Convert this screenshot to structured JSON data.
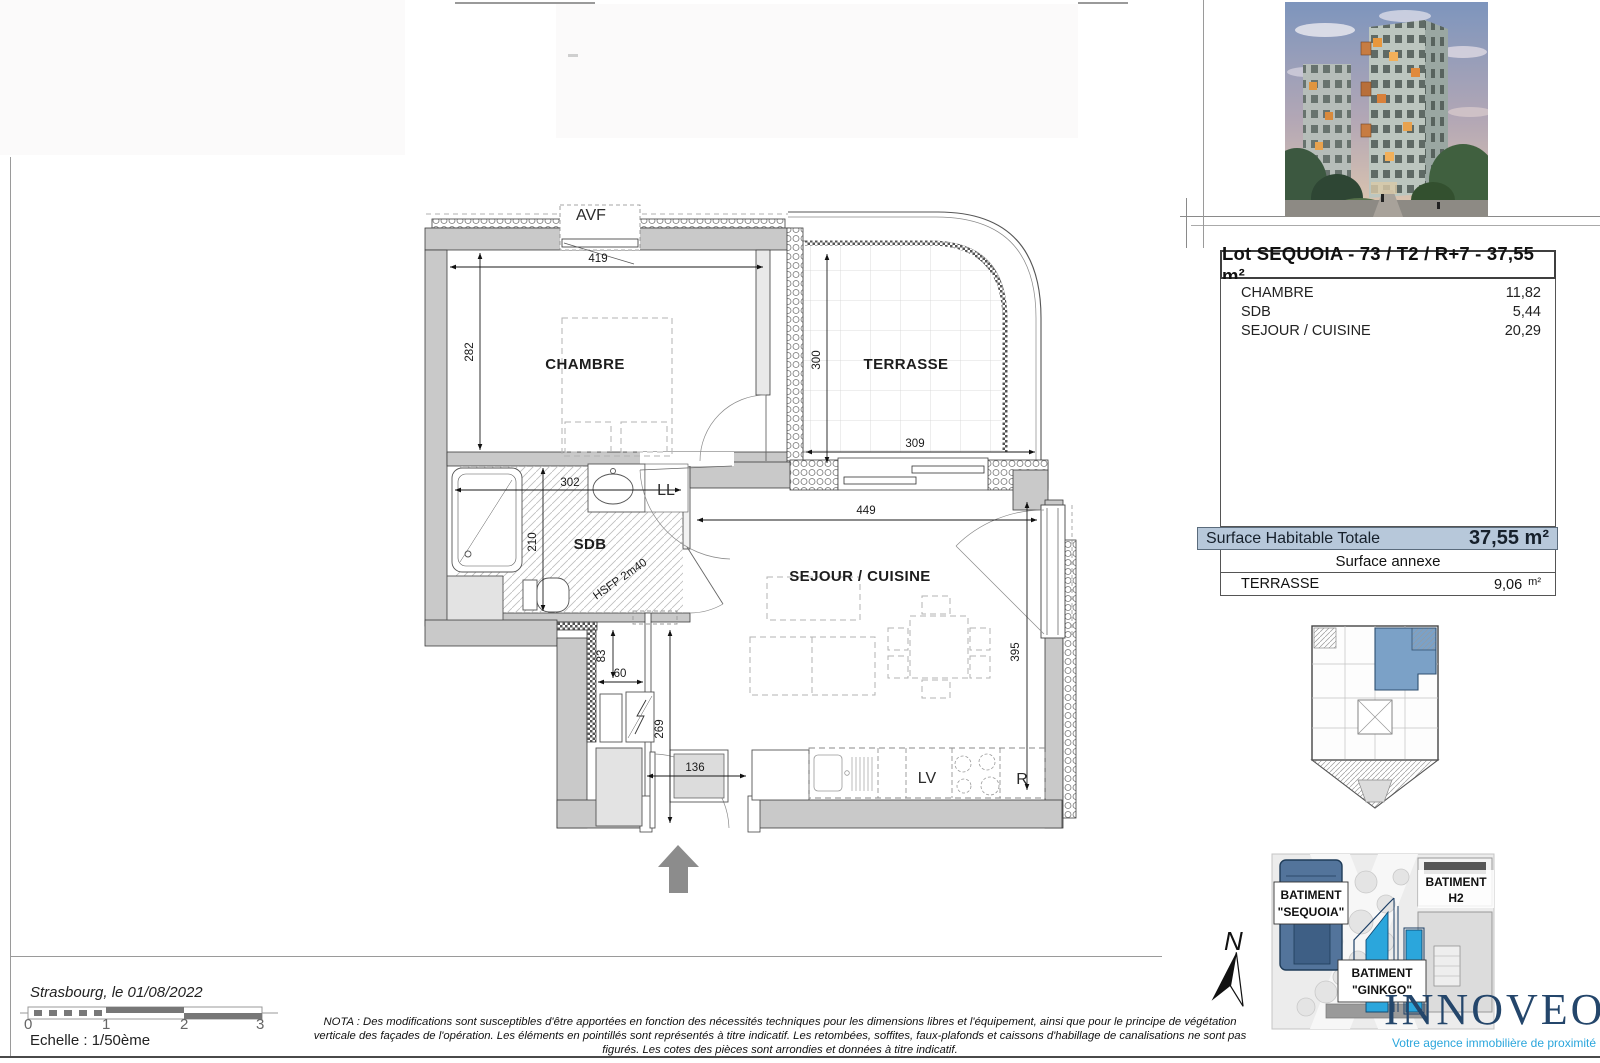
{
  "lot_table": {
    "title": "Lot SEQUOIA - 73 / T2 / R+7 - 37,55 m²",
    "rooms": [
      {
        "name": "CHAMBRE",
        "area": "11,82"
      },
      {
        "name": "SDB",
        "area": "5,44"
      },
      {
        "name": "SEJOUR / CUISINE",
        "area": "20,29"
      }
    ],
    "total_label": "Surface Habitable Totale",
    "total_value": "37,55 m²",
    "annex_header": "Surface annexe",
    "annex_room": {
      "name": "TERRASSE",
      "area": "9,06",
      "unit": "m²"
    }
  },
  "plan": {
    "room_labels": {
      "chambre": "CHAMBRE",
      "terrasse": "TERRASSE",
      "sdb": "SDB",
      "sejour": "SEJOUR / CUISINE"
    },
    "equipment_labels": {
      "avf": "AVF",
      "ll": "LL",
      "lv": "LV",
      "fridge": "R",
      "ceiling_height": "HSFP 2m40"
    },
    "dimensions": {
      "chambre_width": "419",
      "chambre_height": "282",
      "terrasse_height": "300",
      "terrasse_width": "309",
      "sdb_width": "302",
      "sdb_height": "210",
      "sejour_width": "449",
      "sejour_height": "395",
      "hall_depth": "83",
      "hall_width": "60",
      "hall_height": "269",
      "entry_width": "136"
    }
  },
  "north_label": "N",
  "site_plan": {
    "buildings": [
      {
        "line1": "BATIMENT",
        "line2": "\"SEQUOIA\""
      },
      {
        "line1": "BATIMENT",
        "line2": "H2"
      },
      {
        "line1": "BATIMENT",
        "line2": "\"GINKGO\""
      }
    ]
  },
  "branding": {
    "wordmark": "INNOVEO",
    "tagline": "Votre agence immobilière de proximité"
  },
  "footer": {
    "date_line": "Strasbourg, le 01/08/2022",
    "scale_ticks": [
      "0",
      "1",
      "2",
      "3"
    ],
    "scale_label": "Echelle : 1/50ème",
    "nota": "NOTA : Des modifications sont susceptibles d'être apportées en fonction des nécessités techniques pour les dimensions libres et l'équipement, ainsi que pour le principe de végétation verticale des façades de l'opération. Les éléments en pointillés sont représentés à titre indicatif. Les retombées, soffites, faux-plafonds et caissons d'habillage de canalisations ne sont pas figurés. Les cotes des pièces sont arrondies et données à titre indicatif."
  },
  "colors": {
    "highlight_row": "#b7c8da",
    "unit_highlight": "#7ba1c7",
    "brand_navy": "#24466b",
    "brand_cyan": "#2ba6dc"
  }
}
